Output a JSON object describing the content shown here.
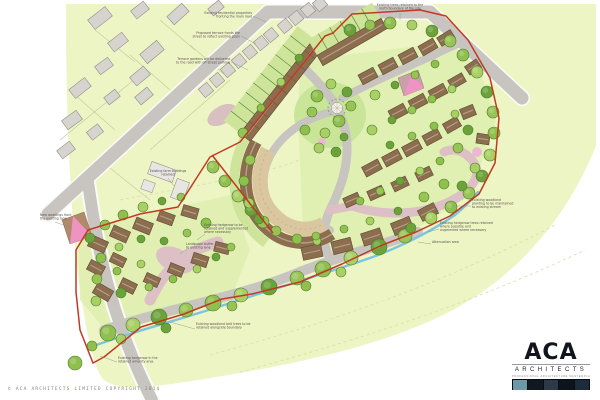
{
  "plan": {
    "annotations": [
      {
        "x": 252,
        "y": 14,
        "anchor": "end",
        "lines": [
          "Existing residential properties",
          "fronting the main road"
        ]
      },
      {
        "x": 240,
        "y": 34,
        "anchor": "end",
        "lines": [
          "Proposed terrace fronts the",
          "street to reflect existing grain"
        ]
      },
      {
        "x": 230,
        "y": 60,
        "anchor": "end",
        "lines": [
          "Terrace gardens will be delivered",
          "to the road with off street parking"
        ]
      },
      {
        "x": 400,
        "y": 6,
        "anchor": "middle",
        "lines": [
          "Existing trees retained to the",
          "north boundary of the site"
        ]
      },
      {
        "x": 168,
        "y": 172,
        "anchor": "middle",
        "lines": [
          "Existing farm buildings",
          "retained"
        ]
      },
      {
        "x": 204,
        "y": 226,
        "anchor": "start",
        "lines": [
          "Existing hedgerow to be",
          "retained and supplemented",
          "where necessary"
        ]
      },
      {
        "x": 186,
        "y": 245,
        "anchor": "start",
        "lines": [
          "Landscape buffer",
          "to existing lane"
        ]
      },
      {
        "x": 472,
        "y": 201,
        "anchor": "start",
        "lines": [
          "Existing woodland",
          "planting to be maintained",
          "to existing stream"
        ]
      },
      {
        "x": 440,
        "y": 224,
        "anchor": "start",
        "lines": [
          "Existing hedgerow trees retained",
          "where possible and",
          "augmented where necessary"
        ]
      },
      {
        "x": 432,
        "y": 243,
        "anchor": "start",
        "lines": [
          "Attenuation area"
        ]
      },
      {
        "x": 196,
        "y": 325,
        "anchor": "start",
        "lines": [
          "Existing woodland belt trees to be",
          "retained alongside boundary"
        ]
      },
      {
        "x": 118,
        "y": 359,
        "anchor": "start",
        "lines": [
          "Existing hedgerow in the",
          "retained amenity area"
        ]
      },
      {
        "x": 40,
        "y": 216,
        "anchor": "start",
        "lines": [
          "New dwellings front",
          "the existing lane"
        ]
      }
    ]
  },
  "footer": {
    "copyright": "© ACA ARCHITECTS LIMITED COPYRIGHT 2014"
  },
  "logo": {
    "name": "ACA",
    "subtitle": "ARCHITECTS",
    "tagline": "PROFESSIONAL ARCHITECTURE MASTERPLANNING DESIGN"
  },
  "colors": {
    "land": "#eef5c5",
    "road": "#c8c5c1",
    "site_boundary_red": "#c03a21",
    "stream_blue": "#7cc4e0",
    "proposed_roof_brown": "#8c6d4e",
    "existing_building_gray": "#d7d4d0",
    "shared_surface_pink": "#dcc0c6",
    "garden_green": "#cfe49b",
    "tree_greens": [
      "#8fbf4d",
      "#a9d065",
      "#6ba33a",
      "#97c455"
    ],
    "accent_pink": "#ef93c3"
  }
}
